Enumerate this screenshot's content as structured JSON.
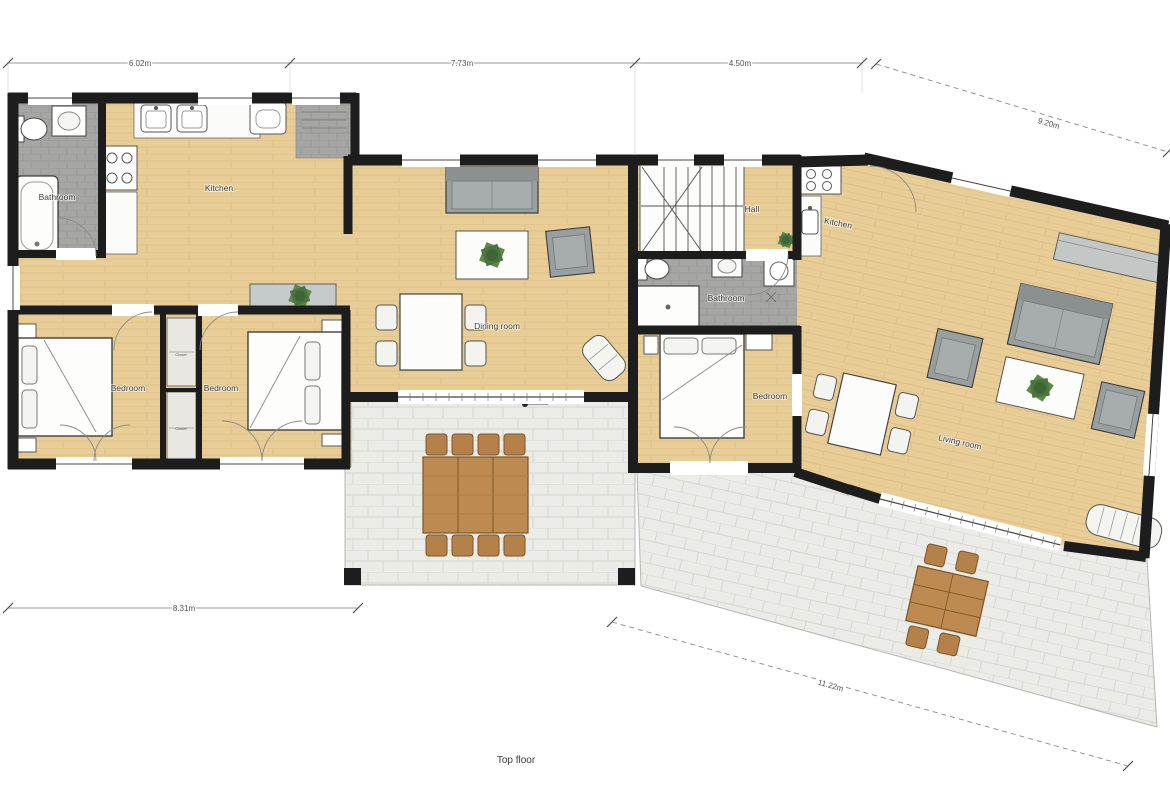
{
  "title": "Top floor",
  "dimensions": {
    "top_left": "6.02m",
    "top_mid": "7.73m",
    "top_right": "4.50m",
    "right_diagonal": "9.20m",
    "bottom_left": "8.31m",
    "bottom_diagonal": "11.22m"
  },
  "rooms": {
    "bathroom1": "Bathroom",
    "kitchen1": "Kitchen",
    "bedroom1": "Bedroom",
    "bedroom2": "Bedroom",
    "closet1": "Closet",
    "closet2": "Closet",
    "dining": "Dining room",
    "hall": "Hall",
    "bathroom2": "Bathroom",
    "kitchen2": "Kitchen",
    "bedroom3": "Bedroom",
    "living": "Living room"
  },
  "colors": {
    "wall": "#1d1d1d",
    "wood_floor": "#e8cd97",
    "bath_tile": "#a6a6a4",
    "terrace_tile": "#ebebe7",
    "furniture_gray": "#999f9f",
    "outdoor_wood": "#bd8a52",
    "plant_green": "#5d8a49"
  }
}
